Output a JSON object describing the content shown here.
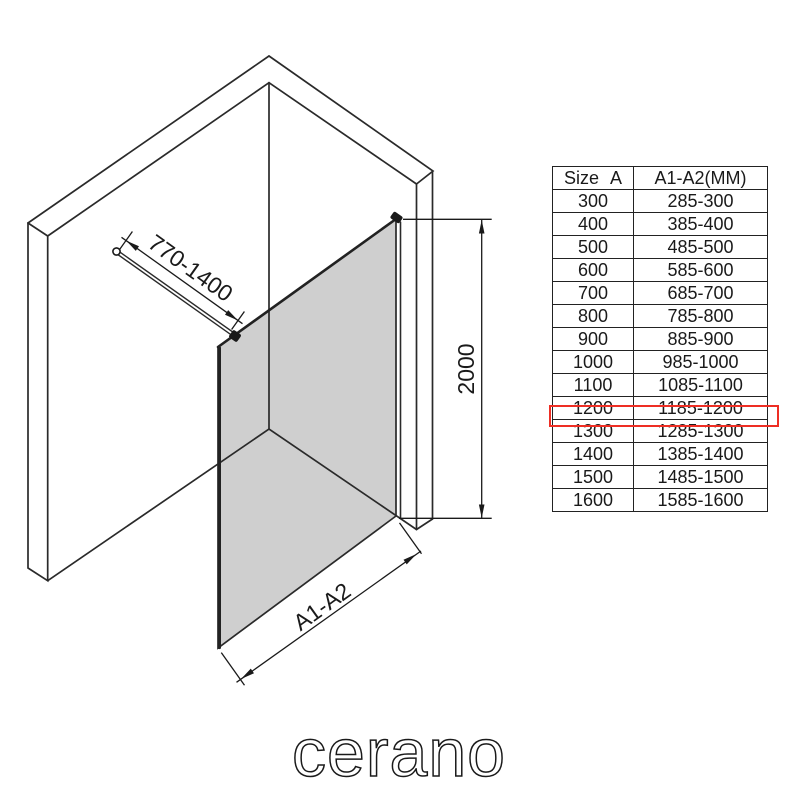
{
  "brand": {
    "logo_text": "cerano"
  },
  "diagram": {
    "dim_width_label": "770-1400",
    "dim_height_label": "2000",
    "dim_bottom_label": "A1-A2",
    "glass_color": "#cfcfcf",
    "line_color": "#2a2a2a",
    "highlight_color": "#ee2e24"
  },
  "table": {
    "headers": {
      "size": "Size A",
      "range": "A1-A2(MM)"
    },
    "highlighted_size": "1200",
    "rows": [
      {
        "size": "300",
        "range": "285-300"
      },
      {
        "size": "400",
        "range": "385-400"
      },
      {
        "size": "500",
        "range": "485-500"
      },
      {
        "size": "600",
        "range": "585-600"
      },
      {
        "size": "700",
        "range": "685-700"
      },
      {
        "size": "800",
        "range": "785-800"
      },
      {
        "size": "900",
        "range": "885-900"
      },
      {
        "size": "1000",
        "range": "985-1000"
      },
      {
        "size": "1100",
        "range": "1085-1100"
      },
      {
        "size": "1200",
        "range": "1185-1200"
      },
      {
        "size": "1300",
        "range": "1285-1300"
      },
      {
        "size": "1400",
        "range": "1385-1400"
      },
      {
        "size": "1500",
        "range": "1485-1500"
      },
      {
        "size": "1600",
        "range": "1585-1600"
      }
    ]
  }
}
